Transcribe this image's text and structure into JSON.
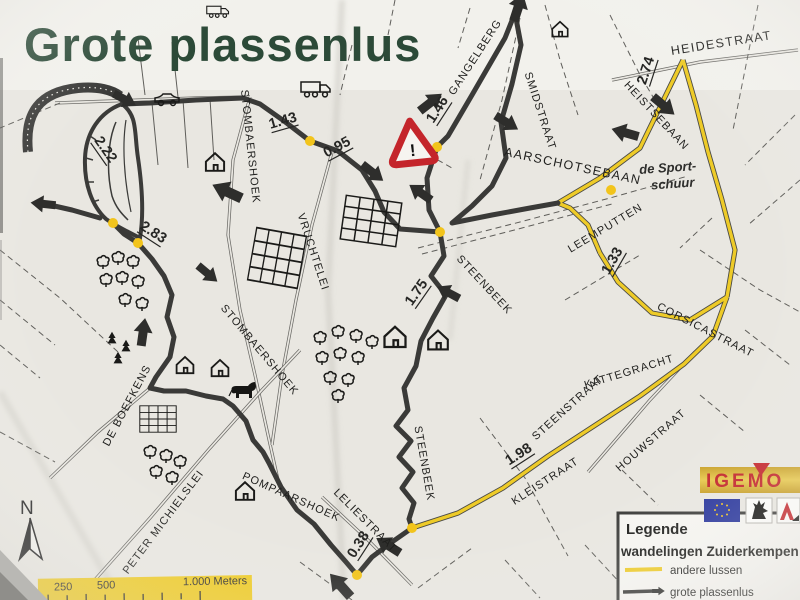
{
  "title": "Grote plassenlus",
  "map": {
    "streets": [
      {
        "name": "STOMBAERSHOEK"
      },
      {
        "name": "STOMBAERSHOEK"
      },
      {
        "name": "VRUCHTELEI"
      },
      {
        "name": "GANGELBERG"
      },
      {
        "name": "SMIDSTRAAT"
      },
      {
        "name": "AARSCHOTSEBAAN"
      },
      {
        "name": "HEIDESTRAAT"
      },
      {
        "name": "HEISTSEBAAN"
      },
      {
        "name": "LEEMPUTTEN"
      },
      {
        "name": "CORSICASTRAAT"
      },
      {
        "name": "KATTEGRACHT"
      },
      {
        "name": "STEENSTRAAT"
      },
      {
        "name": "HOUWSTRAAT"
      },
      {
        "name": "KLEISTRAAT"
      },
      {
        "name": "STEENBEEK"
      },
      {
        "name": "STEENBEEK"
      },
      {
        "name": "LELIESTRAAT"
      },
      {
        "name": "POMPAARSHOEK"
      },
      {
        "name": "PETER MICHIELSLEI"
      },
      {
        "name": "DE BOEFKENS"
      }
    ],
    "distances": [
      {
        "value": "2.22"
      },
      {
        "value": "2.83"
      },
      {
        "value": "1.43"
      },
      {
        "value": "0.95"
      },
      {
        "value": "1.46"
      },
      {
        "value": "2.74"
      },
      {
        "value": "1.33"
      },
      {
        "value": "1.75"
      },
      {
        "value": "1.98"
      },
      {
        "value": "0.38"
      }
    ],
    "landmark": {
      "line1": "de Sport-",
      "line2": "schuur"
    },
    "warning_symbol": "!",
    "north_label": "N"
  },
  "scale_bar": {
    "label_250": "250",
    "label_500": "500",
    "label_1000": "1.000 Meters"
  },
  "legend": {
    "heading": "Legende",
    "subtitle": "wandelingen Zuiderkempen",
    "items": [
      {
        "label": "andere lussen",
        "color": "#eecb28"
      },
      {
        "label": "grote plassenlus",
        "color": "#3a3a38"
      }
    ]
  },
  "logos": {
    "igemo": "IGEMO"
  },
  "colors": {
    "paper": "#e9e7e1",
    "route_main": "#3a3a38",
    "route_other": "#eecb28",
    "title_green": "#2c4a38",
    "warning_red": "#c4252b",
    "scale_band": "#eecb28"
  }
}
